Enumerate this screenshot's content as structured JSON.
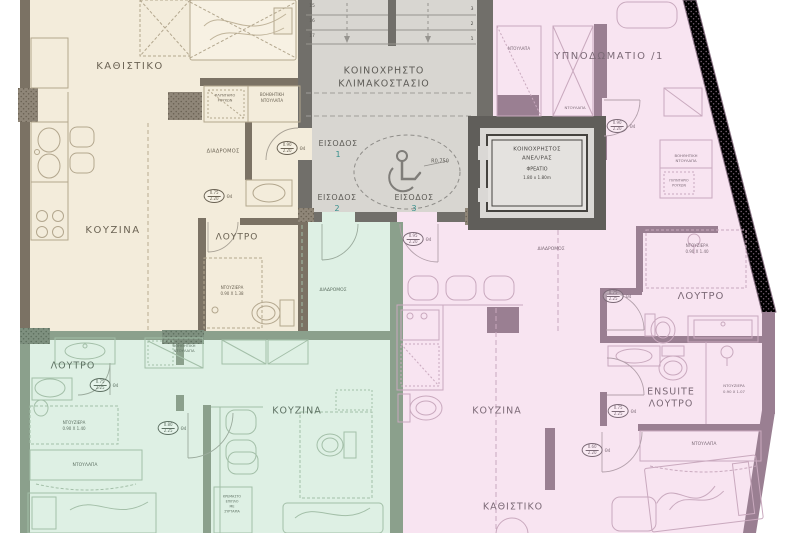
{
  "colors": {
    "beige_fill": "#f3ecdb",
    "beige_wall": "#7b7264",
    "beige_text": "#6b6354",
    "stair_fill": "#d8d6d1",
    "stair_wall": "#716f6a",
    "stair_text": "#5d5b56",
    "elevator_wall": "#605e5a",
    "pink_fill": "#f8e4f1",
    "pink_wall": "#9a7f92",
    "pink_text": "#7c6a77",
    "green_fill": "#def0e4",
    "green_wall": "#8ba08c",
    "green_text": "#5e7163",
    "entrance_number": "#37908d"
  },
  "apartment_beige": {
    "living": "ΚΑΘΙΣΤΙΚΟ",
    "kitchen": "ΚΟΥΖΙΝΑ",
    "bath": "ΛΟΥΤΡΟ",
    "corridor": "ΔΙΑΔΡΟΜΟΣ",
    "aux_closet_1": "ΒΟΗΘΗΤΙΚΗ",
    "aux_closet_2": "ΝΤΟΥΛΑΠΑ",
    "washer_1": "ΠΛΥΝΤΗΡΙΟ",
    "washer_2": "ΡΟΥΧΩΝ",
    "shower_1": "ΝΤΟΥΖΙΕΡΑ",
    "shower_2": "0.90 Χ 1.38"
  },
  "stairwell": {
    "name_1": "ΚΟΙΝΟΧΡΗΣΤΟ",
    "name_2": "ΚΛΙΜΑΚΟΣΤΑΣΙΟ",
    "entrance_label": "ΕΙΣΟΔΟΣ",
    "entrance_1": "1",
    "entrance_2": "2",
    "entrance_3": "3",
    "radius_label": "R0.750",
    "steps_left": [
      "15",
      "16",
      "17"
    ],
    "steps_right": [
      "3",
      "2",
      "1"
    ]
  },
  "elevator": {
    "line_1": "ΚΟΙΝΟΧΡΗΣΤΟΣ",
    "line_2": "ΑΝΕΛ/ΡΑΣ",
    "line_3": "ΦΡΕΑΤΙΟ",
    "line_4": "1.80 x 1.80m"
  },
  "apartment_pink": {
    "bedroom": "ΥΠΝΟΔΩΜΑΤΙΟ /1",
    "closet_top": "ΝΤΟΥΛΑΠΑ",
    "closet_mid": "ΝΤΟΥΛΑΠΑ",
    "aux_closet_1": "ΒΟΗΘΗΤΙΚΗ",
    "aux_closet_2": "ΝΤΟΥΛΑΠΑ",
    "washer_1": "ΠΛΥΝΤΗΡΙΟ",
    "washer_2": "ΡΟΥΧΩΝ",
    "shower1_1": "ΝΤΟΥΖΙΕΡΑ",
    "shower1_2": "0.90 Χ 1.40",
    "bath": "ΛΟΥΤΡΟ",
    "corridor": "ΔΙΑΔΡΟΜΟΣ",
    "kitchen": "ΚΟΥΖΙΝΑ",
    "living": "ΚΑΘΙΣΤΙΚΟ",
    "ensuite_1": "ENSUITE",
    "ensuite_2": "ΛΟΥΤΡΟ",
    "shower2_1": "ΝΤΟΥΖΙΕΡΑ",
    "shower2_2": "0.90 Χ 1.07",
    "wardrobe": "ΝΤΟΥΛΑΠΑ"
  },
  "apartment_green": {
    "bath": "ΛΟΥΤΡΟ",
    "shower_1": "ΝΤΟΥΖΙΕΡΑ",
    "shower_2": "0.90 Χ 1.40",
    "wardrobe": "ΝΤΟΥΛΑΠΑ",
    "kitchen": "ΚΟΥΖΙΝΑ",
    "corridor": "ΔΙΑΔΡΟΜΟΣ",
    "aux_closet_1": "ΒΟΗΘΗΤΙΚΗ",
    "aux_closet_2": "ΝΤΟΥΛΑΠΑ",
    "cabinet_note_1": "ΚΡΕΜΑΣΤΟ",
    "cabinet_note_2": "ΕΠΙΠΛΟ",
    "cabinet_note_3": "ΜΕ",
    "cabinet_note_4": "ΣΥΡΤΑΡΙΑ"
  },
  "door_markers": [
    {
      "w": "0.90",
      "h": "2.20",
      "tag": "Θ4"
    },
    {
      "w": "0.75",
      "h": "2.20",
      "tag": "Θ4"
    },
    {
      "w": "0.95",
      "h": "2.20",
      "tag": "Θ4"
    },
    {
      "w": "0.90",
      "h": "2.20",
      "tag": "Θ4"
    },
    {
      "w": "0.75",
      "h": "2.25",
      "tag": "Θ4"
    },
    {
      "w": "0.75",
      "h": "2.25",
      "tag": "Θ4"
    },
    {
      "w": "0.60",
      "h": "2.20",
      "tag": "Θ4"
    },
    {
      "w": "0.75",
      "h": "2.25",
      "tag": "Θ4"
    },
    {
      "w": "0.80",
      "h": "2.25",
      "tag": "Θ4"
    }
  ]
}
